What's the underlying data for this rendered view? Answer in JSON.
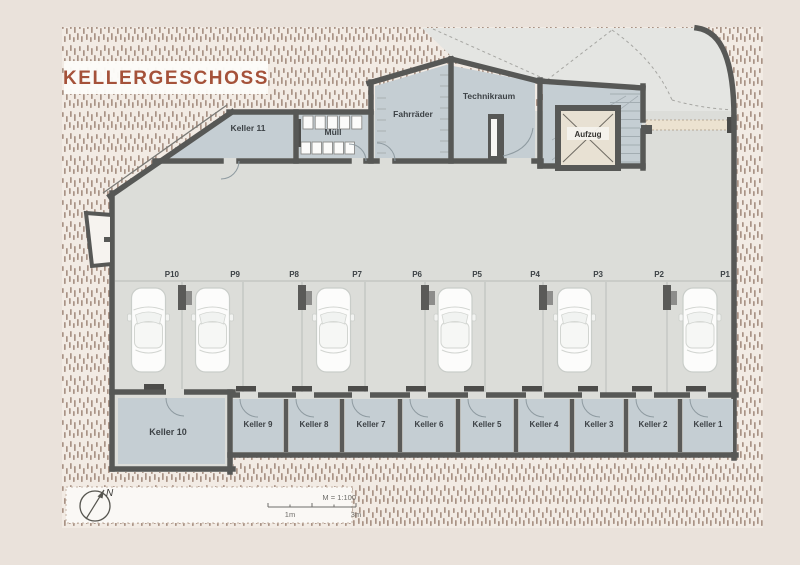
{
  "title": {
    "label": "KELLERGESCHOSS"
  },
  "rooms": {
    "keller11": {
      "label": "Keller 11"
    },
    "muell": {
      "label": "Müll",
      "bins_top": 5,
      "bins_bottom": 5
    },
    "fahrraeder": {
      "label": "Fahrräder",
      "rack_ticks_left": 6,
      "rack_ticks_right": 8
    },
    "technikraum": {
      "label": "Technikraum"
    },
    "aufzug": {
      "label": "Aufzug"
    }
  },
  "parking": {
    "stalls": [
      {
        "label": "P10",
        "x0": 115,
        "x1": 182,
        "car": true
      },
      {
        "label": "P9",
        "x0": 182,
        "x1": 243,
        "car": true
      },
      {
        "label": "P8",
        "x0": 243,
        "x1": 302,
        "car": false
      },
      {
        "label": "P7",
        "x0": 302,
        "x1": 365,
        "car": true
      },
      {
        "label": "P6",
        "x0": 365,
        "x1": 425,
        "car": false
      },
      {
        "label": "P5",
        "x0": 425,
        "x1": 485,
        "car": true
      },
      {
        "label": "P4",
        "x0": 485,
        "x1": 543,
        "car": false
      },
      {
        "label": "P3",
        "x0": 543,
        "x1": 606,
        "car": true
      },
      {
        "label": "P2",
        "x0": 606,
        "x1": 667,
        "car": false
      },
      {
        "label": "P1",
        "x0": 667,
        "x1": 733,
        "car": true
      }
    ],
    "columns_at": [
      182,
      302,
      425,
      543,
      667
    ]
  },
  "keller_row": [
    {
      "label": "Keller 10",
      "x0": 112,
      "x1": 233
    },
    {
      "label": "Keller 9",
      "x0": 230,
      "x1": 286
    },
    {
      "label": "Keller 8",
      "x0": 286,
      "x1": 342
    },
    {
      "label": "Keller 7",
      "x0": 342,
      "x1": 400
    },
    {
      "label": "Keller 6",
      "x0": 400,
      "x1": 458
    },
    {
      "label": "Keller 5",
      "x0": 458,
      "x1": 516
    },
    {
      "label": "Keller 4",
      "x0": 516,
      "x1": 572
    },
    {
      "label": "Keller 3",
      "x0": 572,
      "x1": 626
    },
    {
      "label": "Keller 2",
      "x0": 626,
      "x1": 680
    },
    {
      "label": "Keller 1",
      "x0": 680,
      "x1": 736
    }
  ],
  "legend": {
    "scale_label": "M = 1:100",
    "tick_left": "1m",
    "tick_right": "3m",
    "north_label": "N"
  },
  "colors": {
    "background": "#eae2db",
    "hatch_bg": "#f2ebe4",
    "hatch_dash": "#9c8375",
    "wall": "#575856",
    "floor": "#dcddd9",
    "driveway": "#e4e5e2",
    "room": "#c5ced3",
    "title_accent": "#a5523a",
    "car": "#fcfcfb",
    "walkway": "#ece2d0",
    "elevator_fill": "#e8e1d3"
  }
}
